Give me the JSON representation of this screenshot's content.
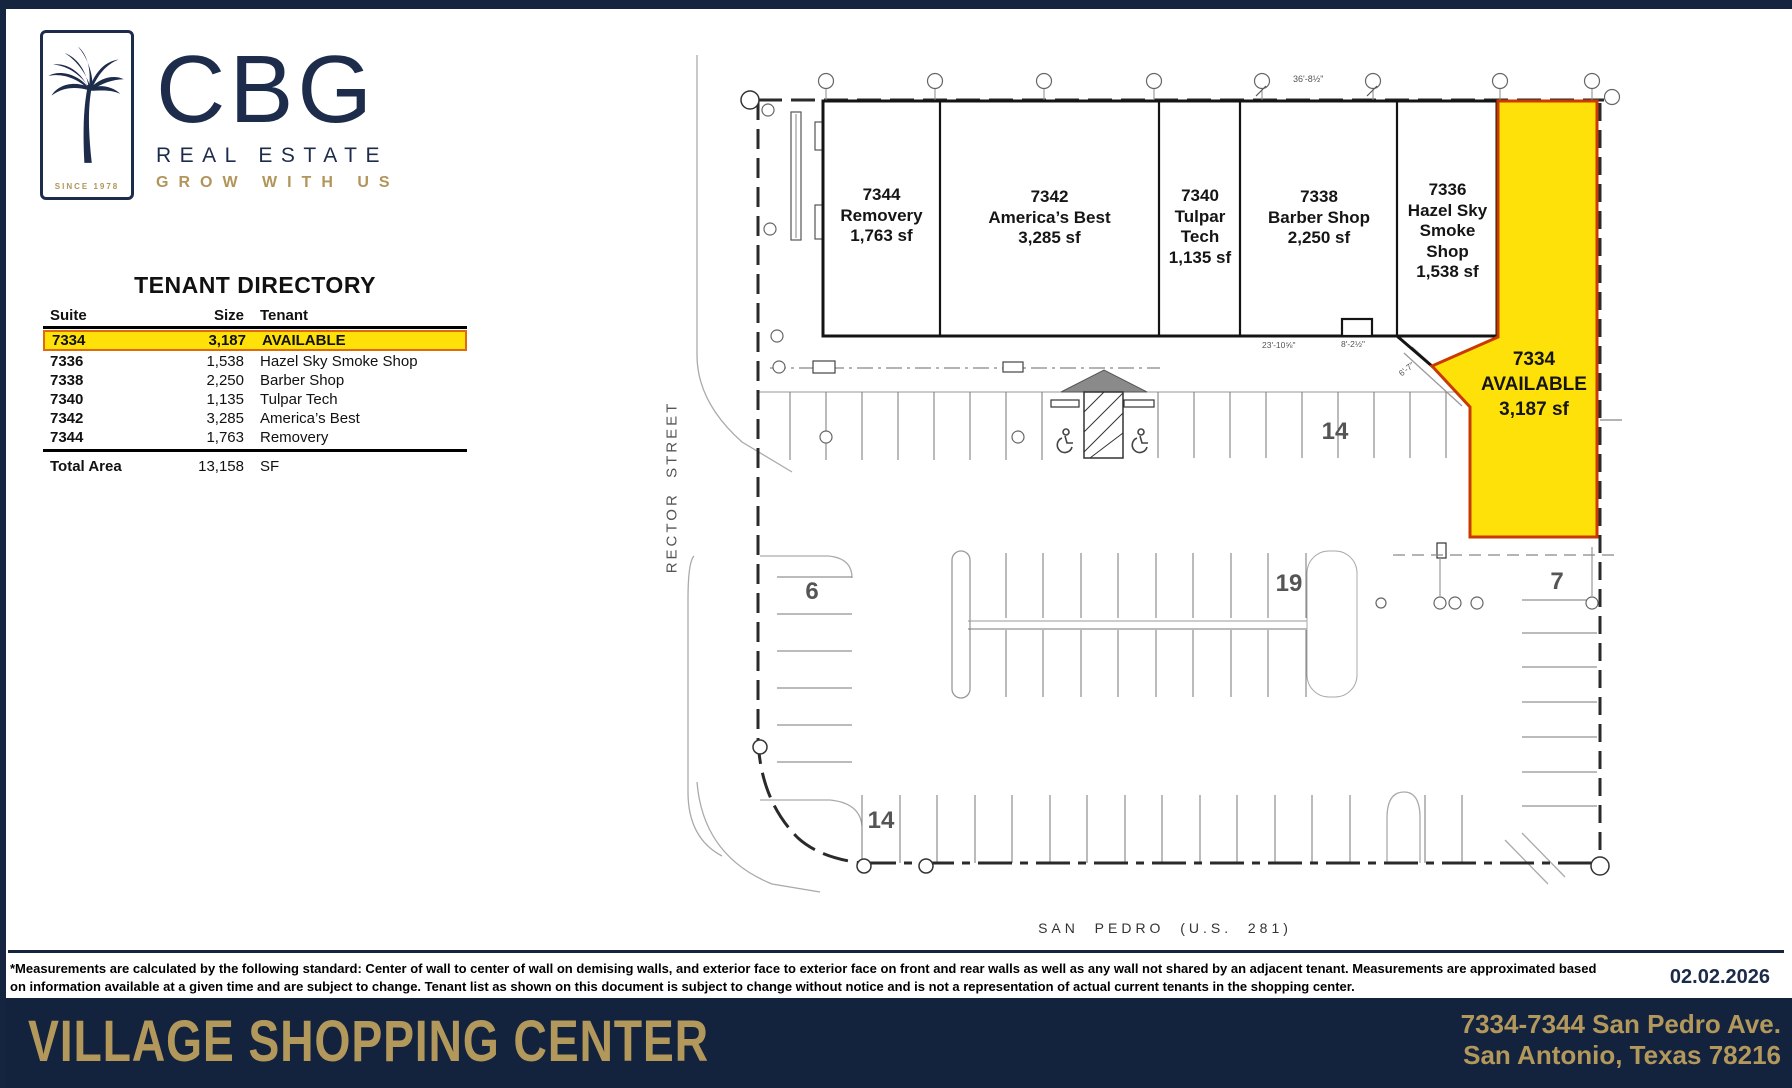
{
  "brand": {
    "company": "CBG",
    "line1": "REAL ESTATE",
    "line2": "GROW WITH US",
    "since": "SINCE 1978"
  },
  "colors": {
    "navy": "#1e2c4c",
    "band_navy": "#14233d",
    "gold": "#b2955a",
    "highlight_yellow": "#ffe10a",
    "highlight_border": "#c93a00",
    "table_row_border": "#e06a10"
  },
  "directory": {
    "title": "TENANT DIRECTORY",
    "columns": {
      "suite": "Suite",
      "size": "Size",
      "tenant": "Tenant"
    },
    "rows": [
      {
        "suite": "7334",
        "size": "3,187",
        "tenant": "AVAILABLE"
      },
      {
        "suite": "7336",
        "size": "1,538",
        "tenant": "Hazel Sky Smoke Shop"
      },
      {
        "suite": "7338",
        "size": "2,250",
        "tenant": "Barber Shop"
      },
      {
        "suite": "7340",
        "size": "1,135",
        "tenant": "Tulpar Tech"
      },
      {
        "suite": "7342",
        "size": "3,285",
        "tenant": "America’s Best"
      },
      {
        "suite": "7344",
        "size": "1,763",
        "tenant": "Removery"
      }
    ],
    "total": {
      "label": "Total Area",
      "size": "13,158",
      "unit": "SF"
    }
  },
  "plan": {
    "streets": {
      "west": "RECTOR  STREET",
      "south": "SAN  PEDRO  (U.S.  281)"
    },
    "suites": [
      {
        "id": "7344",
        "tenant": "Removery",
        "size": "1,763 sf"
      },
      {
        "id": "7342",
        "tenant": "America’s Best",
        "size": "3,285 sf"
      },
      {
        "id": "7340",
        "tenant": "Tulpar Tech",
        "size": "1,135 sf"
      },
      {
        "id": "7338",
        "tenant": "Barber Shop",
        "size": "2,250 sf"
      },
      {
        "id": "7336",
        "tenant": "Hazel Sky Smoke Shop",
        "size": "1,538 sf"
      }
    ],
    "available": {
      "id": "7334",
      "status": "AVAILABLE",
      "size": "3,187 sf"
    },
    "parking": {
      "front": "14",
      "west": "6",
      "middle": "19",
      "south": "14",
      "east": "7"
    },
    "dimensions": {
      "top": "36'-8½\"",
      "a": "23'-10⅝\"",
      "b": "8'-2½\"",
      "c": "6'-7\""
    }
  },
  "footer": {
    "disclaimer_line1": "*Measurements are calculated by the following standard: Center of wall to center of wall on demising walls, and exterior face to exterior face on front and rear walls as well as any wall not shared by an adjacent tenant. Measurements are approximated based",
    "disclaimer_line2": "on information available at a given time and are subject to change. Tenant list as shown on this document is subject to change without notice and is not a representation of actual current tenants in the shopping center.",
    "date": "02.02.2026"
  },
  "banner": {
    "title": "VILLAGE SHOPPING CENTER",
    "address_line1": "7334-7344 San Pedro Ave.",
    "address_line2": "San Antonio, Texas 78216"
  }
}
